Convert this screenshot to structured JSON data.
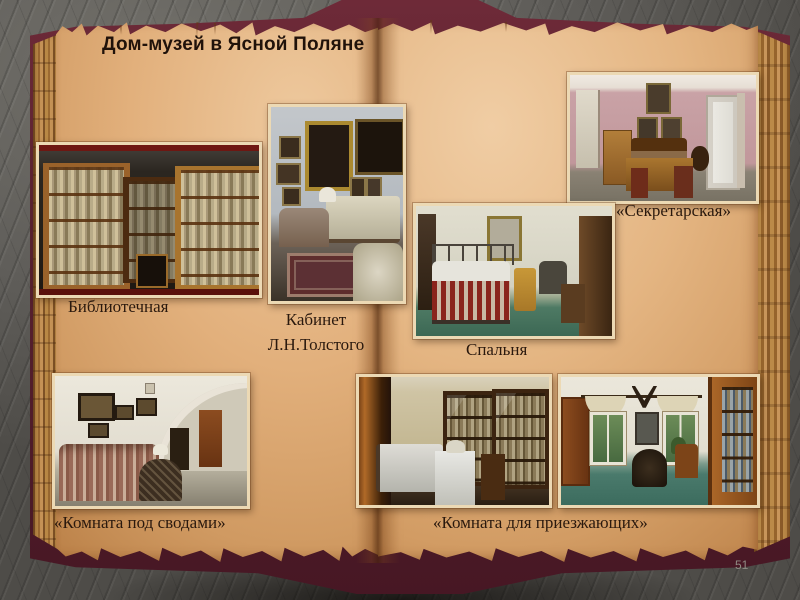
{
  "slide": {
    "title": "Дом-музей в Ясной Поляне",
    "page_number": "51",
    "captions": {
      "library": "Библиотечная",
      "study": "Кабинет\nЛ.Н.Толстого",
      "secretary": "«Секретарская»",
      "bedroom": "Спальня",
      "vaulted_room": "«Комната под сводами»",
      "guest_room": "«Комната для приезжающих»"
    },
    "photos": [
      {
        "name": "library-photo",
        "depicts": "dark room with tall wooden bookcases full of books and a chair"
      },
      {
        "name": "study-photo",
        "depicts": "Tolstoy's study: framed portraits on grey wall, sofa, table, lamp, rug, armchair"
      },
      {
        "name": "secretary-photo",
        "depicts": "pink-walled room with desk, chairs, cabinet, bench, framed pictures and white door"
      },
      {
        "name": "bedroom-photo",
        "depicts": "bedroom with metal bed, striped blanket, chairs, coat rack, green floor"
      },
      {
        "name": "vaulted-room-photo",
        "depicts": "white vaulted room with striped sofa, round table with lamp, framed pictures, arch and door"
      },
      {
        "name": "guest-room-photo-1",
        "depicts": "guest room with wardrobe, white bed, white table and glass-front bookcases"
      },
      {
        "name": "guest-room-photo-2",
        "depicts": "guest room with two curtained windows, antlers, round table, chair and bookcase, teal floor"
      }
    ]
  },
  "colors": {
    "background": "#64625e",
    "page_parchment": "#e2b07c",
    "book_cover": "#5a2230",
    "title_text": "#20120a",
    "caption_text": "#2a190e",
    "page_number_text": "#908c84",
    "photo_border": "#ecd9b4"
  }
}
